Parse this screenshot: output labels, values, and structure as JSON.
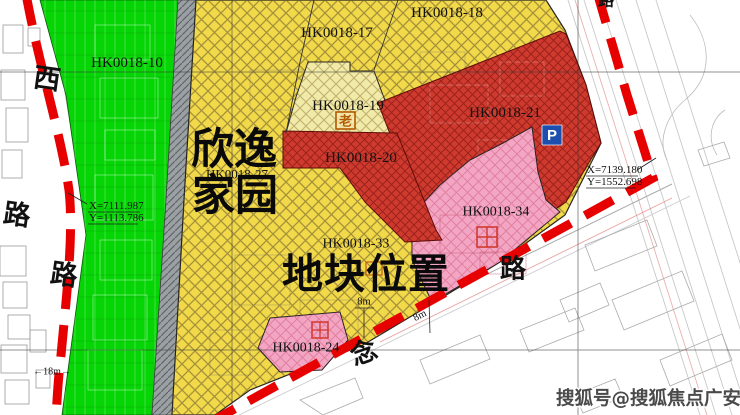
{
  "parcels": {
    "p10": {
      "label": "HK0018-10"
    },
    "p17": {
      "label": "HK0018-17"
    },
    "p18": {
      "label": "HK0018-18"
    },
    "p19": {
      "label": "HK0018-19",
      "symbol": "老"
    },
    "p20": {
      "label": "HK0018-20"
    },
    "p21": {
      "label": "HK0018-21",
      "symbol": "P"
    },
    "p27": {
      "label": "HK0018-27"
    },
    "p33": {
      "label": "HK0018-33"
    },
    "p34": {
      "label": "HK0018-34",
      "symbol": "cross-square-icon"
    },
    "p24": {
      "label": "HK0018-24",
      "symbol": "cross-square-icon"
    }
  },
  "site": {
    "name_line1": "欣逸",
    "name_line2": "家园",
    "location_label": "地块位置"
  },
  "roads": {
    "west_char": "西",
    "left_road_char": "路",
    "left_road_char2": "路",
    "bottom_road_char_nian": "念",
    "bottom_road_char_lu": "路",
    "top_right_char": "路"
  },
  "coords": {
    "left": {
      "x": "X=7111.987",
      "y": "Y=1113.786"
    },
    "right": {
      "x": "X=7139.180",
      "y": "Y=1552.698"
    }
  },
  "dimensions": {
    "left_road_width": "←18m→",
    "road_width_a": "8m",
    "road_width_b": "8m"
  },
  "watermark": "搜狐号@搜狐焦点广安站",
  "colors": {
    "green_parcel": "#05d505",
    "yellow_parcel": "#f2d94a",
    "light_yellow_parcel": "#f2eaa8",
    "red_parcel": "#cf3a2e",
    "pink_parcel": "#f3a6c3",
    "gray_road_strip": "#9aa0a3",
    "boundary_dash_red": "#e60000",
    "parking_blue": "#1d4fae",
    "elder_orange": "#b35900",
    "watermark_gray": "#4a4a4a"
  }
}
